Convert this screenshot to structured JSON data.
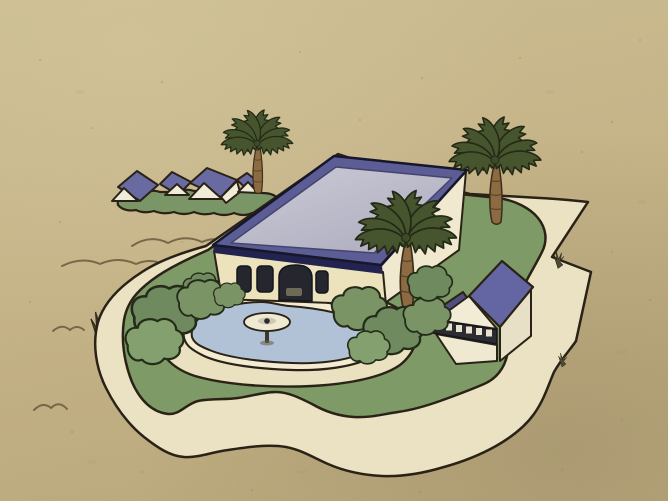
{
  "labels": {
    "scene": "Cartoon aerial view of a desert estate: mansion with flat lavender roof, kidney-shaped swimming pool with fountain, palm trees, garage outbuilding, curving driveway, small houses on a green patch in the distance, sand all around"
  },
  "colors": {
    "sand": "#c6b488",
    "sand_light": "#d3c59b",
    "sand_dark": "#a2916c",
    "speckle": "#8f7d5a",
    "scribble": "#6b5a3d",
    "outline": "#2a2216",
    "estate_base": "#eae2c2",
    "lawn": "#7e9a67",
    "patch_green": "#7a9566",
    "bush": "#7a9466",
    "bush_dark": "#6f8a5e",
    "bush_light": "#83a06e",
    "pool_apron": "#e9e1c0",
    "pool_coping": "#f3ecd2",
    "pool_water": "#b2c2d6",
    "fountain": "#f0ead2",
    "fountain_inner": "#cfc9b2",
    "fountain_center": "#2a2a30",
    "fountain_stem": "#3d382c",
    "roof_border": "#5d5d95",
    "roof_panel": "#bdbdca",
    "roof_fascia": "#23234f",
    "wall": "#ece3bd",
    "wall_bright": "#f0e9cf",
    "window": "#26262e",
    "arch_furniture": "#6d6a55",
    "garage_roof": "#6366a3",
    "garage_roof_shade": "#4f4f7e",
    "garage_gable": "#f2ecd6",
    "garage_wall": "#f0e9d1",
    "garage_wall_shade": "#e8e0c6",
    "garage_band": "#2b2b33",
    "garage_band_square": "#e9e3cd",
    "small_roof": "#6a6aa2",
    "small_gable": "#f1ecd8",
    "palm_frond": "#47552f",
    "palm_trunk": "#8c6a42",
    "palm_trunk_band": "#5a4428",
    "scrub": "#4e4a33"
  }
}
